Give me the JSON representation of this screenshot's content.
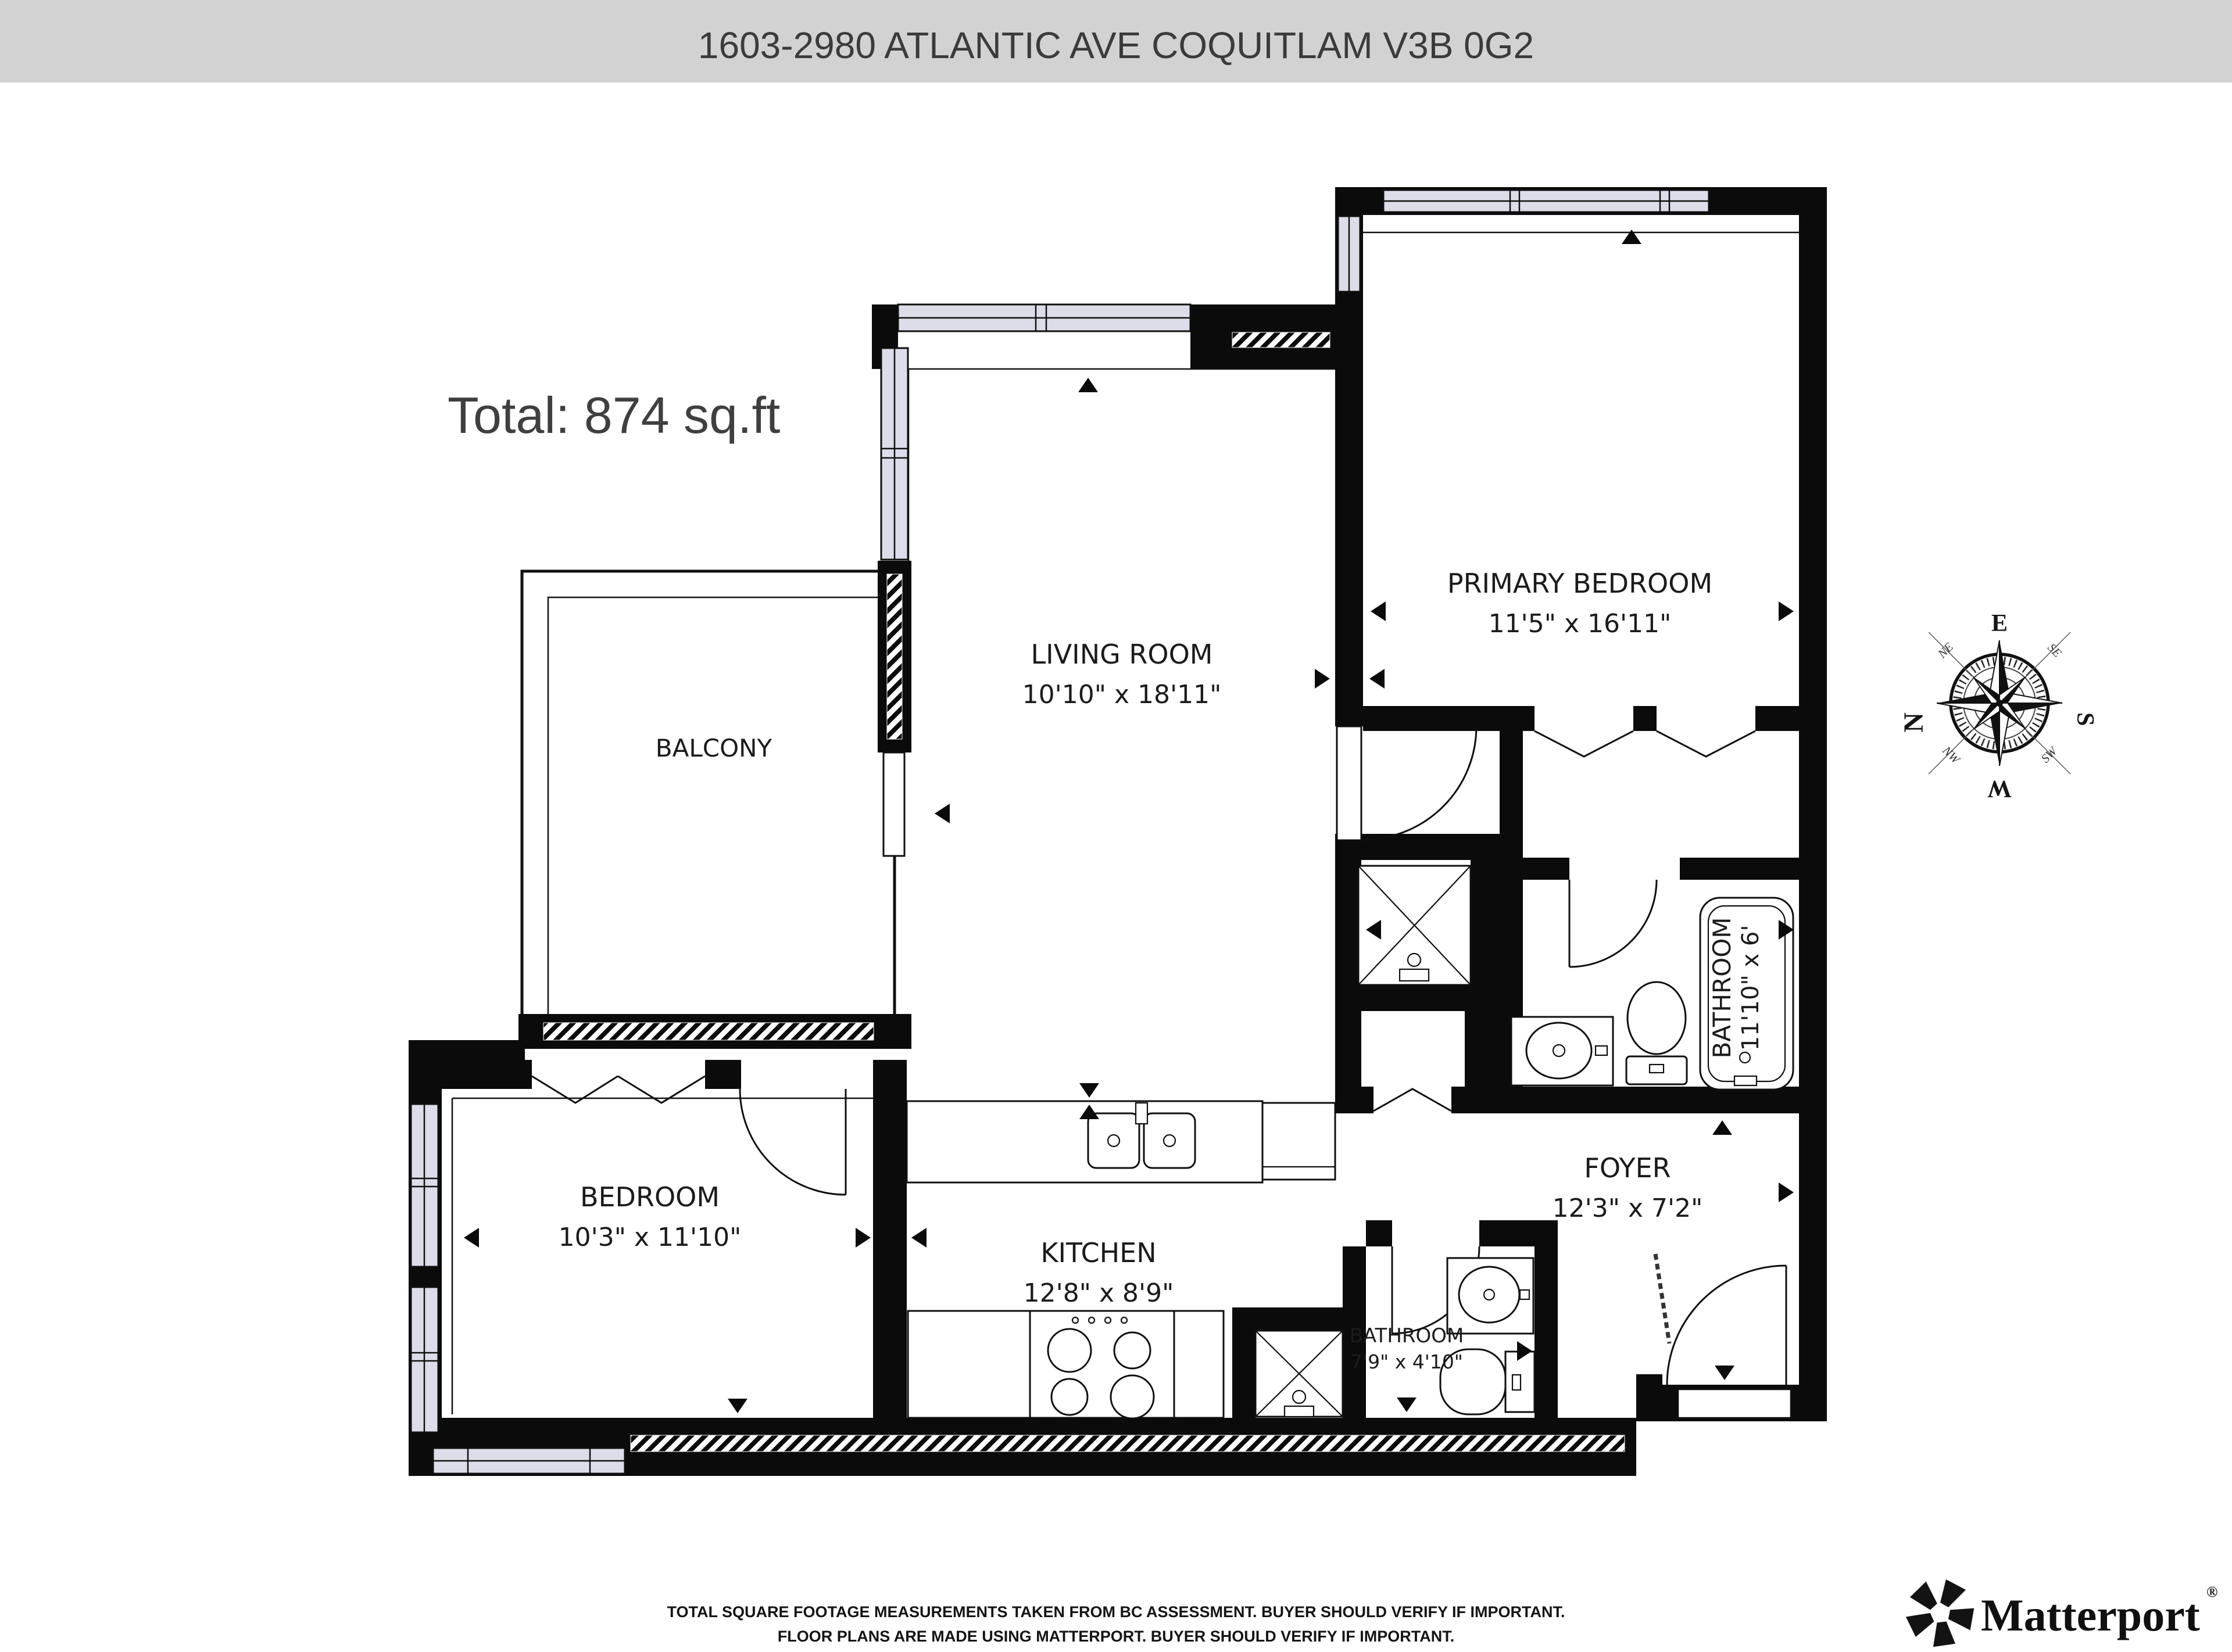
{
  "header": {
    "title": "1603-2980 ATLANTIC AVE COQUITLAM V3B 0G2",
    "bg_color": "#d2d2d2"
  },
  "plan": {
    "total_label": "Total: 874 sq.ft",
    "rooms": {
      "primary_bedroom": {
        "name": "PRIMARY BEDROOM",
        "dims": "11'5\" x 16'11\""
      },
      "living_room": {
        "name": "LIVING ROOM",
        "dims": "10'10\" x 18'11\""
      },
      "balcony": {
        "name": "BALCONY"
      },
      "bedroom": {
        "name": "BEDROOM",
        "dims": "10'3\" x 11'10\""
      },
      "kitchen": {
        "name": "KITCHEN",
        "dims": "12'8\" x 8'9\""
      },
      "bathroom_main": {
        "name": "BATHROOM",
        "dims": "11'10\" x 6'"
      },
      "bathroom_small": {
        "name": "BATHROOM",
        "dims": "7'9\" x 4'10\""
      },
      "foyer": {
        "name": "FOYER",
        "dims": "12'3\" x 7'2\""
      }
    },
    "compass": {
      "n": "N",
      "e": "E",
      "s": "S",
      "w": "W",
      "ne": "NE",
      "se": "SE",
      "sw": "SW",
      "nw": "NW",
      "north_color": "#c0392b"
    }
  },
  "footer": {
    "disclaimer_line1": "TOTAL SQUARE FOOTAGE MEASUREMENTS TAKEN FROM BC ASSESSMENT. BUYER SHOULD VERIFY IF IMPORTANT.",
    "disclaimer_line2": "FLOOR PLANS ARE MADE USING MATTERPORT. BUYER SHOULD VERIFY IF IMPORTANT.",
    "brand": "Matterport",
    "brand_reg": "®"
  },
  "colors": {
    "wall": "#0b0b0b",
    "window_fill": "#dcdde9",
    "header_bg": "#d2d2d2"
  }
}
